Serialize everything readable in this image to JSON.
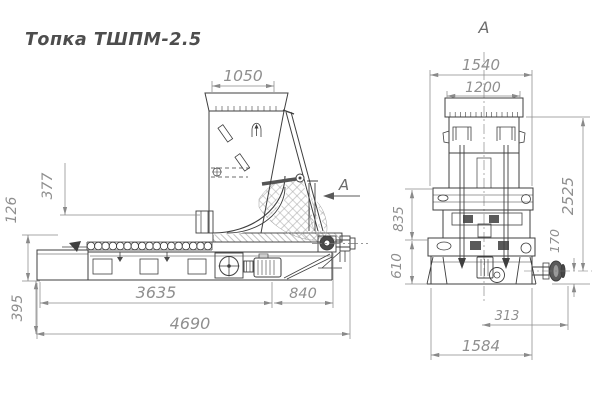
{
  "title": "Топка ТШПМ-2.5",
  "colors": {
    "line": "#3f3f3f",
    "dim_line": "#8a8a8a",
    "dim_text": "#8f8f8f",
    "hatch": "#9a9a9a",
    "background": "#ffffff"
  },
  "side_view": {
    "section_arrow_label": "А",
    "dimensions": {
      "hopper_top_width": "1050",
      "feed_height": "377",
      "grate_height": "126",
      "ash_box_height": "395",
      "grate_length": "3635",
      "drive_length": "840",
      "overall_length": "4690"
    }
  },
  "front_view": {
    "view_label": "А",
    "dimensions": {
      "frame_width": "1540",
      "hopper_width": "1200",
      "upper_height": "835",
      "lower_height": "610",
      "overall_height": "2525",
      "shaft_axis_height": "170",
      "shaft_protrusion": "313",
      "base_width": "1584"
    }
  }
}
